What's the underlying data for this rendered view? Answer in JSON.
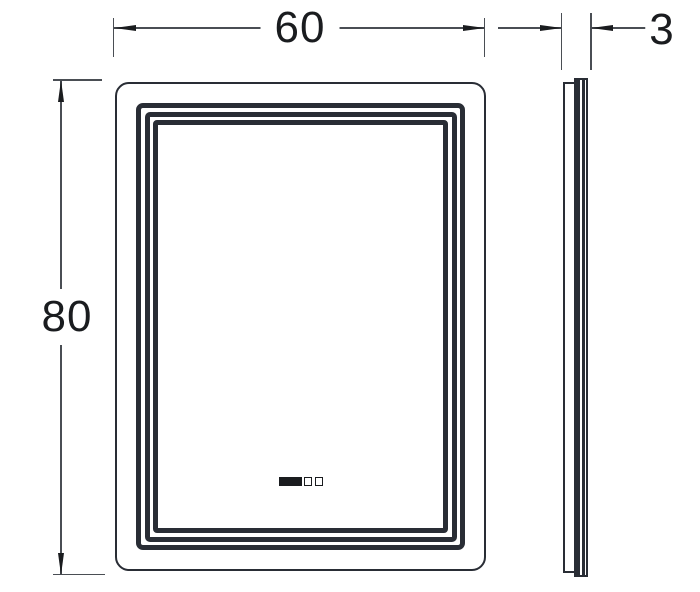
{
  "drawing": {
    "type": "technical-dimension-drawing",
    "subject": "led-mirror-front-and-side-view",
    "dimensions": {
      "width": {
        "label": "60"
      },
      "height": {
        "label": "80"
      },
      "depth": {
        "label": "3"
      }
    },
    "colors": {
      "background": "#ffffff",
      "frame": "#292d35",
      "line": "#4a4e54",
      "text": "#1a1c1f"
    },
    "icons": {
      "sensor_bar": "touch-sensor-bar-icon",
      "sensor_button": "touch-sensor-button-icon",
      "arrows": "dimension-arrowhead-icon"
    }
  }
}
